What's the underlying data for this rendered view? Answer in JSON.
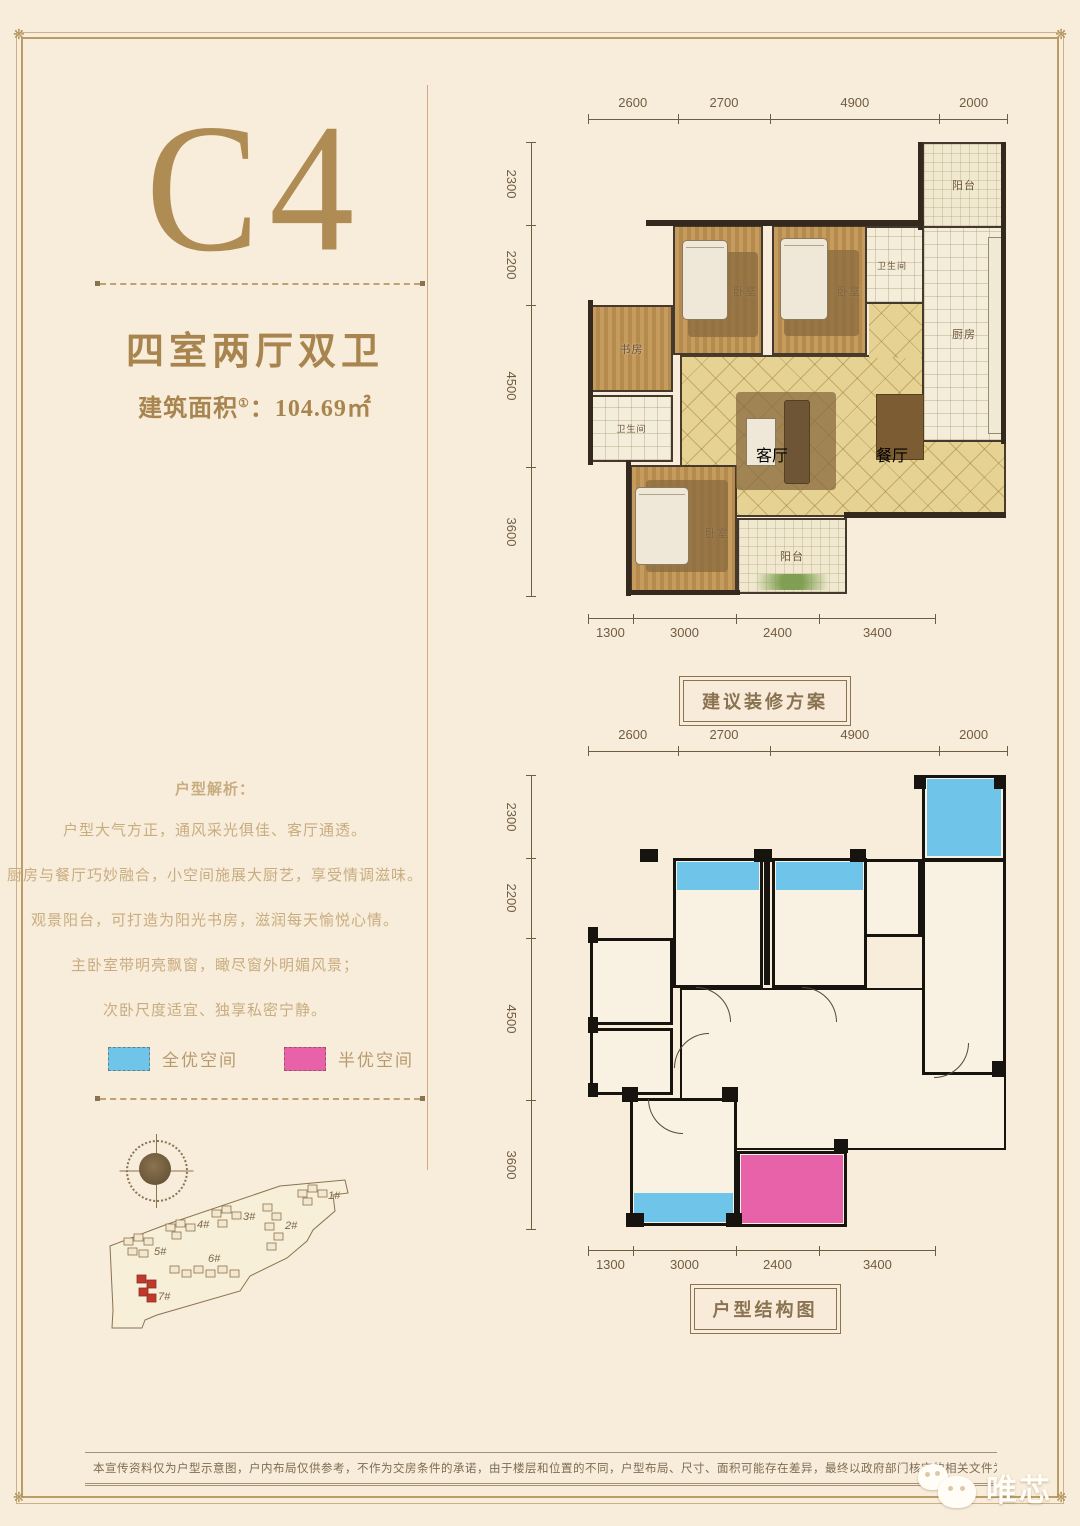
{
  "frame": {
    "ornament": "❋"
  },
  "header": {
    "unit": "C4",
    "type": "四室两厅双卫",
    "area_label": "建筑面积",
    "area_note": "①",
    "area_value": "：104.69㎡"
  },
  "analysis": {
    "title": "户型解析：",
    "lines": [
      "户型大气方正，通风采光俱佳、客厅通透。",
      "厨房与餐厅巧妙融合，小空间施展大厨艺，享受情调滋味。",
      "观景阳台，可打造为阳光书房，滋润每天愉悦心情。",
      "主卧室带明亮飘窗，瞰尽窗外明媚风景；",
      "次卧尺度适宜、独享私密宁静。"
    ]
  },
  "legend": {
    "items": [
      {
        "label": "全优空间",
        "color": "#6fc5e9"
      },
      {
        "label": "半优空间",
        "color": "#e862aa"
      }
    ]
  },
  "site": {
    "buildings": [
      {
        "label": "1#"
      },
      {
        "label": "2#"
      },
      {
        "label": "3#"
      },
      {
        "label": "4#"
      },
      {
        "label": "5#"
      },
      {
        "label": "6#"
      },
      {
        "label": "7#",
        "highlight": true
      }
    ]
  },
  "plan1": {
    "caption": "建议装修方案",
    "dims_top": [
      "2600",
      "2700",
      "4900",
      "2000"
    ],
    "dims_left": [
      "2300",
      "2200",
      "4500",
      "3600"
    ],
    "dims_bottom": [
      "1300",
      "3000",
      "2400",
      "3400"
    ],
    "rooms": {
      "balcony_top": "阳台",
      "kitchen": "厨房",
      "bath_top": "卫生间",
      "bedroom_a": "卧室",
      "bedroom_b": "卧室",
      "study": "书房",
      "bath_left": "卫生间",
      "bedroom_c": "卧室",
      "balcony_bottom": "阳台",
      "living": "客厅",
      "dining": "餐厅"
    }
  },
  "plan2": {
    "caption": "户型结构图",
    "dims_top": [
      "2600",
      "2700",
      "4900",
      "2000"
    ],
    "dims_left": [
      "2300",
      "2200",
      "4500",
      "3600"
    ],
    "dims_bottom": [
      "1300",
      "3000",
      "2400",
      "3400"
    ]
  },
  "footer": {
    "disclaimer": "本宣传资料仅为户型示意图，户内布局仅供参考，不作为交房条件的承诺，由于楼层和位置的不同，户型布局、尺寸、面积可能存在差异，最终以政府部门核定的相关文件为准。",
    "logo": "唯芯"
  }
}
